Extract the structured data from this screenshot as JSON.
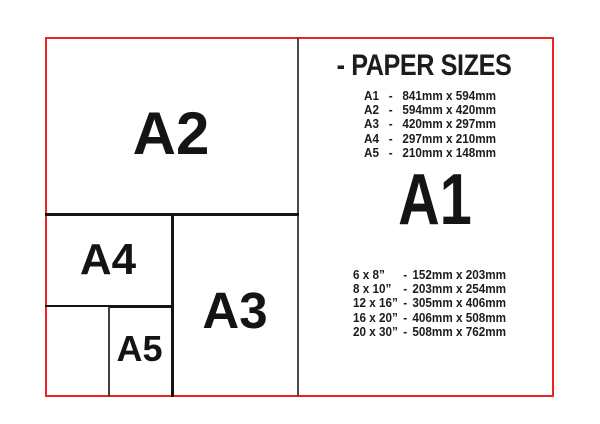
{
  "title": "- PAPER SIZES",
  "separator": "-",
  "featured_size": "A1",
  "diagram": {
    "boxes": [
      {
        "label": "A2"
      },
      {
        "label": "A4"
      },
      {
        "label": "A3"
      },
      {
        "label": "A5"
      }
    ]
  },
  "a_sizes": [
    {
      "label": "A1",
      "dims": "841mm x 594mm"
    },
    {
      "label": "A2",
      "dims": "594mm x 420mm"
    },
    {
      "label": "A3",
      "dims": "420mm x 297mm"
    },
    {
      "label": "A4",
      "dims": "297mm x 210mm"
    },
    {
      "label": "A5",
      "dims": "210mm x 148mm"
    }
  ],
  "inch_sizes": [
    {
      "label": "6 x 8”",
      "dims": "152mm x 203mm"
    },
    {
      "label": "8 x 10”",
      "dims": "203mm x 254mm"
    },
    {
      "label": "12 x 16”",
      "dims": "305mm x 406mm"
    },
    {
      "label": "16 x 20”",
      "dims": "406mm x 508mm"
    },
    {
      "label": "20 x 30”",
      "dims": "508mm x 762mm"
    }
  ],
  "colors": {
    "frame_red": "#ee2424",
    "line_black": "#141414",
    "divider_gray": "#4a4a4a",
    "text": "#1c1c1c"
  }
}
